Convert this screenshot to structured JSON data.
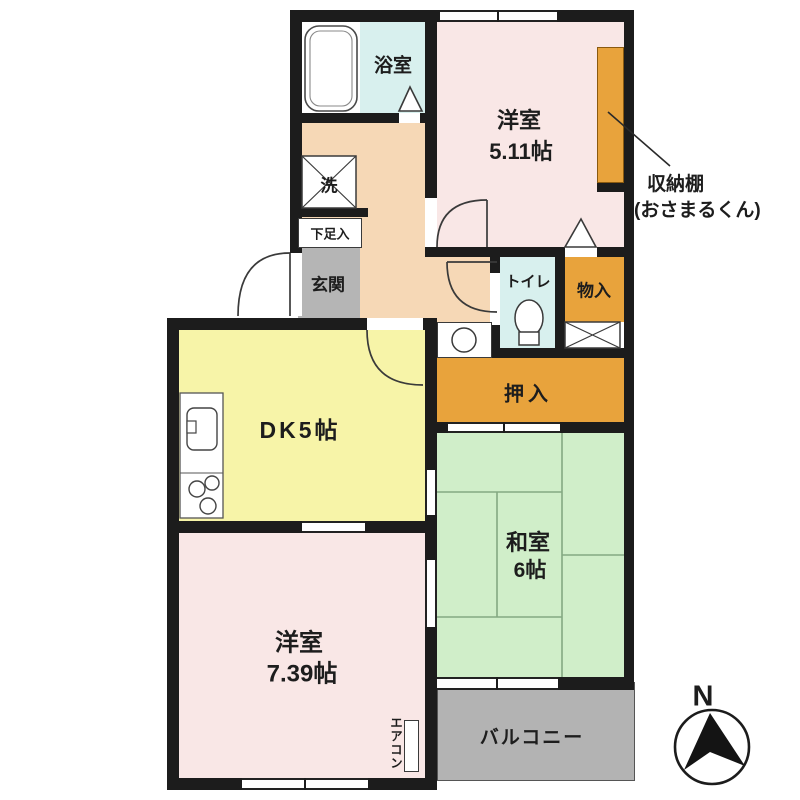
{
  "title": "2DK apartment floor plan",
  "labels": {
    "bathroom": "浴室",
    "washer": "洗",
    "shoe_storage": "下足入",
    "entrance": "玄関",
    "western1_name": "洋室",
    "western1_size": "5.11帖",
    "shelf_note_line1": "収納棚",
    "shelf_note_line2": "(おさまるくん)",
    "toilet": "トイレ",
    "storage_small": "物入",
    "closet": "押入",
    "dk": "DK5帖",
    "japanese_name": "和室",
    "japanese_size": "6帖",
    "western2_name": "洋室",
    "western2_size": "7.39帖",
    "balcony": "バルコニー",
    "aircon": "エアコン",
    "compass_north": "N"
  },
  "colors": {
    "wall": "#1c1c1c",
    "western_room_pink": "#f9e7e6",
    "hallway_peach": "#f6d8b6",
    "dk_yellow": "#f7f4a8",
    "japanese_room_green": "#d0eec9",
    "wet_area_cyan": "#d8f0ee",
    "storage_orange": "#e8a33c",
    "entrance_gray": "#b5b5b5",
    "balcony_gray": "#b3b3b3"
  }
}
